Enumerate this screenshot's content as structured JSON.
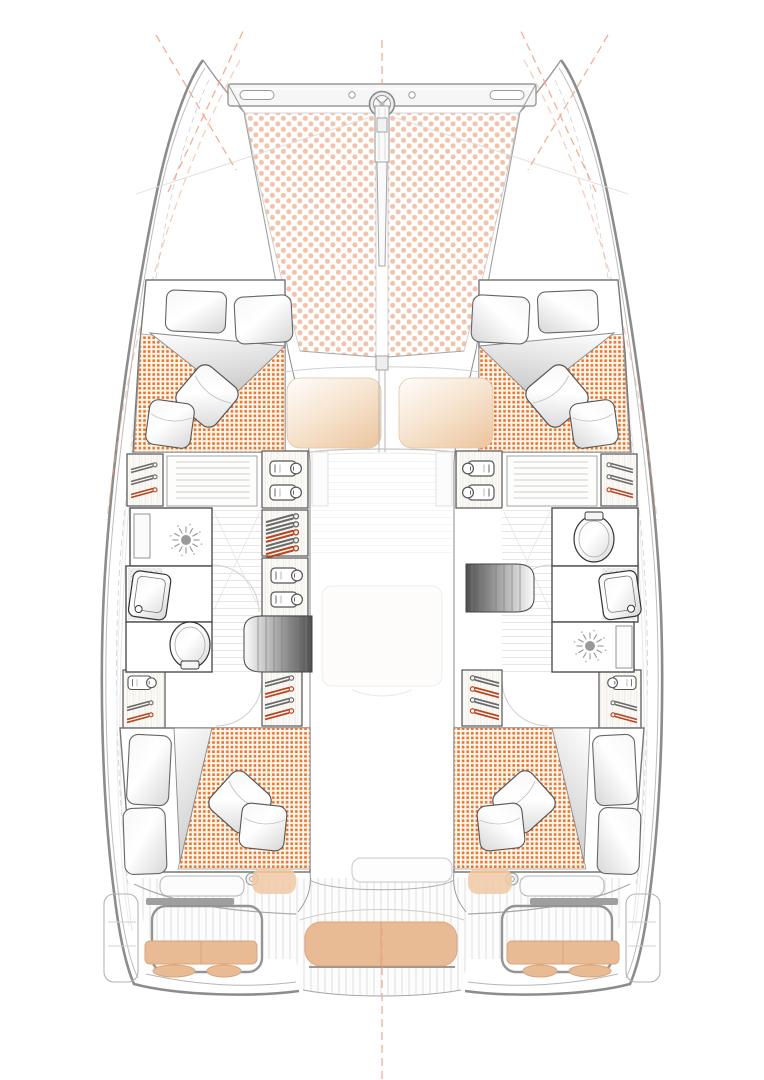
{
  "app": {
    "name": "Catamaran interior and deck layout plan",
    "type": "floor-plan"
  },
  "colors": {
    "duvet_dot": "#e8762c",
    "duvet_bg": "#fff6ee",
    "tramp_dot": "#f3c2a9",
    "seat_peach": "#e9bb95",
    "seat_edge": "#d8a57c",
    "sunpad_hi": "#fffdfb",
    "sunpad_mid": "#f6e3cd",
    "sunpad_lo": "#eec9a5",
    "hull_stroke": "#8c8c8c",
    "wall_stroke": "#4f4f4f",
    "accent_hanger": "#b9441e",
    "construction": "#f2a58b",
    "stair_dark": "#4f4f4f",
    "teak_line": "#dcdcdc"
  },
  "regions": {
    "hull": "Hull",
    "trampoline": "Bow trampoline",
    "crossbeam": "Bow crossbeam",
    "bowsprit": "Bowsprit",
    "sunpad": "Foredeck sunpad",
    "cabin_forward": "Forward double cabin",
    "cabin_aft": "Aft double cabin",
    "bed": "Double bed",
    "wardrobe": "Wardrobe",
    "corridor": "Hull corridor",
    "saloon": "Saloon",
    "cockpit": "Cockpit",
    "bench": "Cockpit bench seat",
    "helm_seat": "Helm seat",
    "swim_platform": "Swim platform",
    "head_port": "Port bathroom",
    "head_starboard": "Starboard bathroom",
    "shower": "Shower",
    "sink": "Washbasin",
    "toilet": "Toilet",
    "stairs_port": "Port companionway stairs",
    "stairs_starboard": "Starboard companionway stairs",
    "winch": "Winch",
    "aft_door": "Saloon aft door"
  },
  "icons": {
    "hanger": "clothes-hanger-icon",
    "shirt": "folded-shirt-icon",
    "shower_rose": "shower-head-icon"
  }
}
